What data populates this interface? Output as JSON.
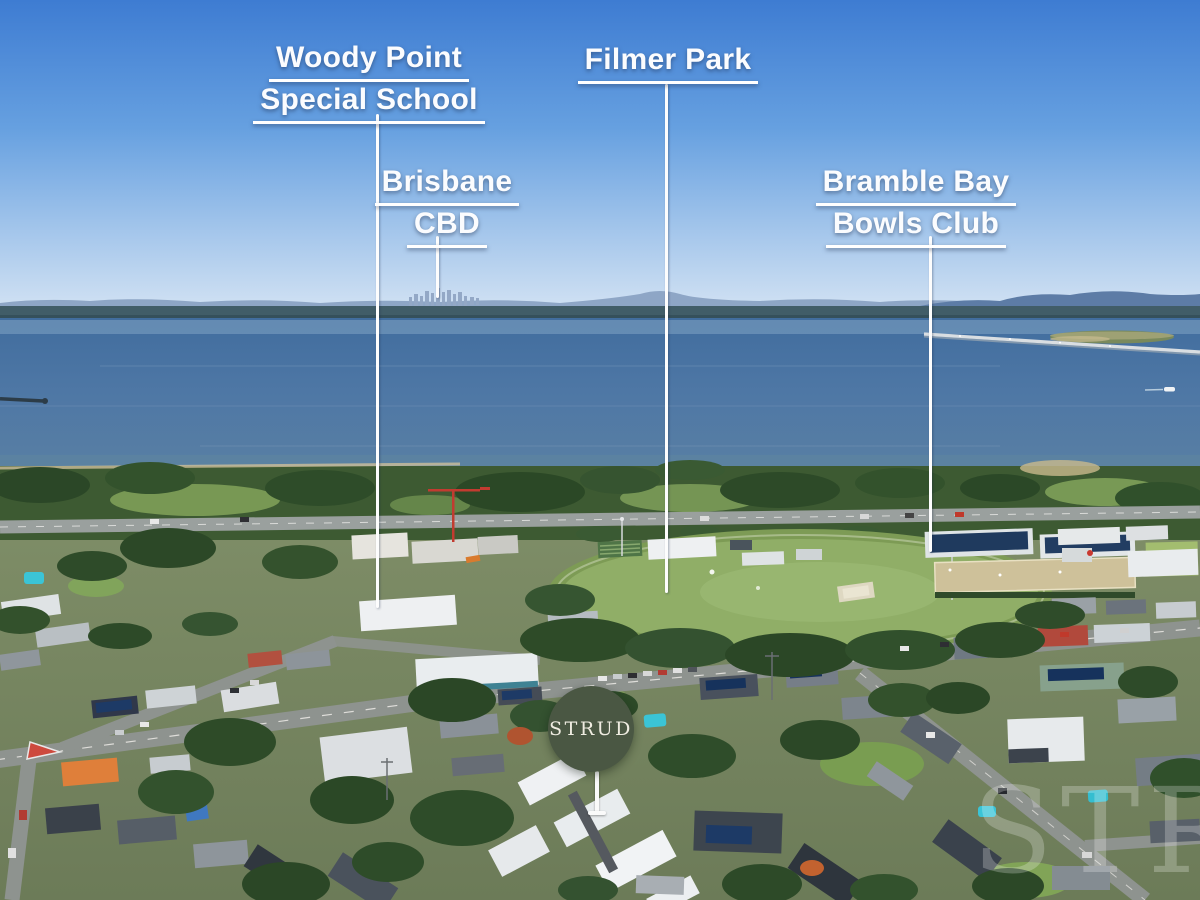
{
  "labels": {
    "woody_point": {
      "line1": "Woody Point",
      "line2": "Special School"
    },
    "filmer_park": {
      "line1": "Filmer Park"
    },
    "brisbane_cbd": {
      "line1": "Brisbane",
      "line2": "CBD"
    },
    "bramble_bay": {
      "line1": "Bramble Bay",
      "line2": "Bowls Club"
    }
  },
  "badge": {
    "text": "STRUD",
    "background_color": "#4a5743",
    "text_color": "#efece1"
  },
  "watermark": {
    "text": "STRUD"
  },
  "colors": {
    "label_text": "#ffffff",
    "pointer_line": "#ffffff",
    "sky_top": "#3e7cd2",
    "water": "#47719f",
    "oval_green": "#8fae66"
  }
}
